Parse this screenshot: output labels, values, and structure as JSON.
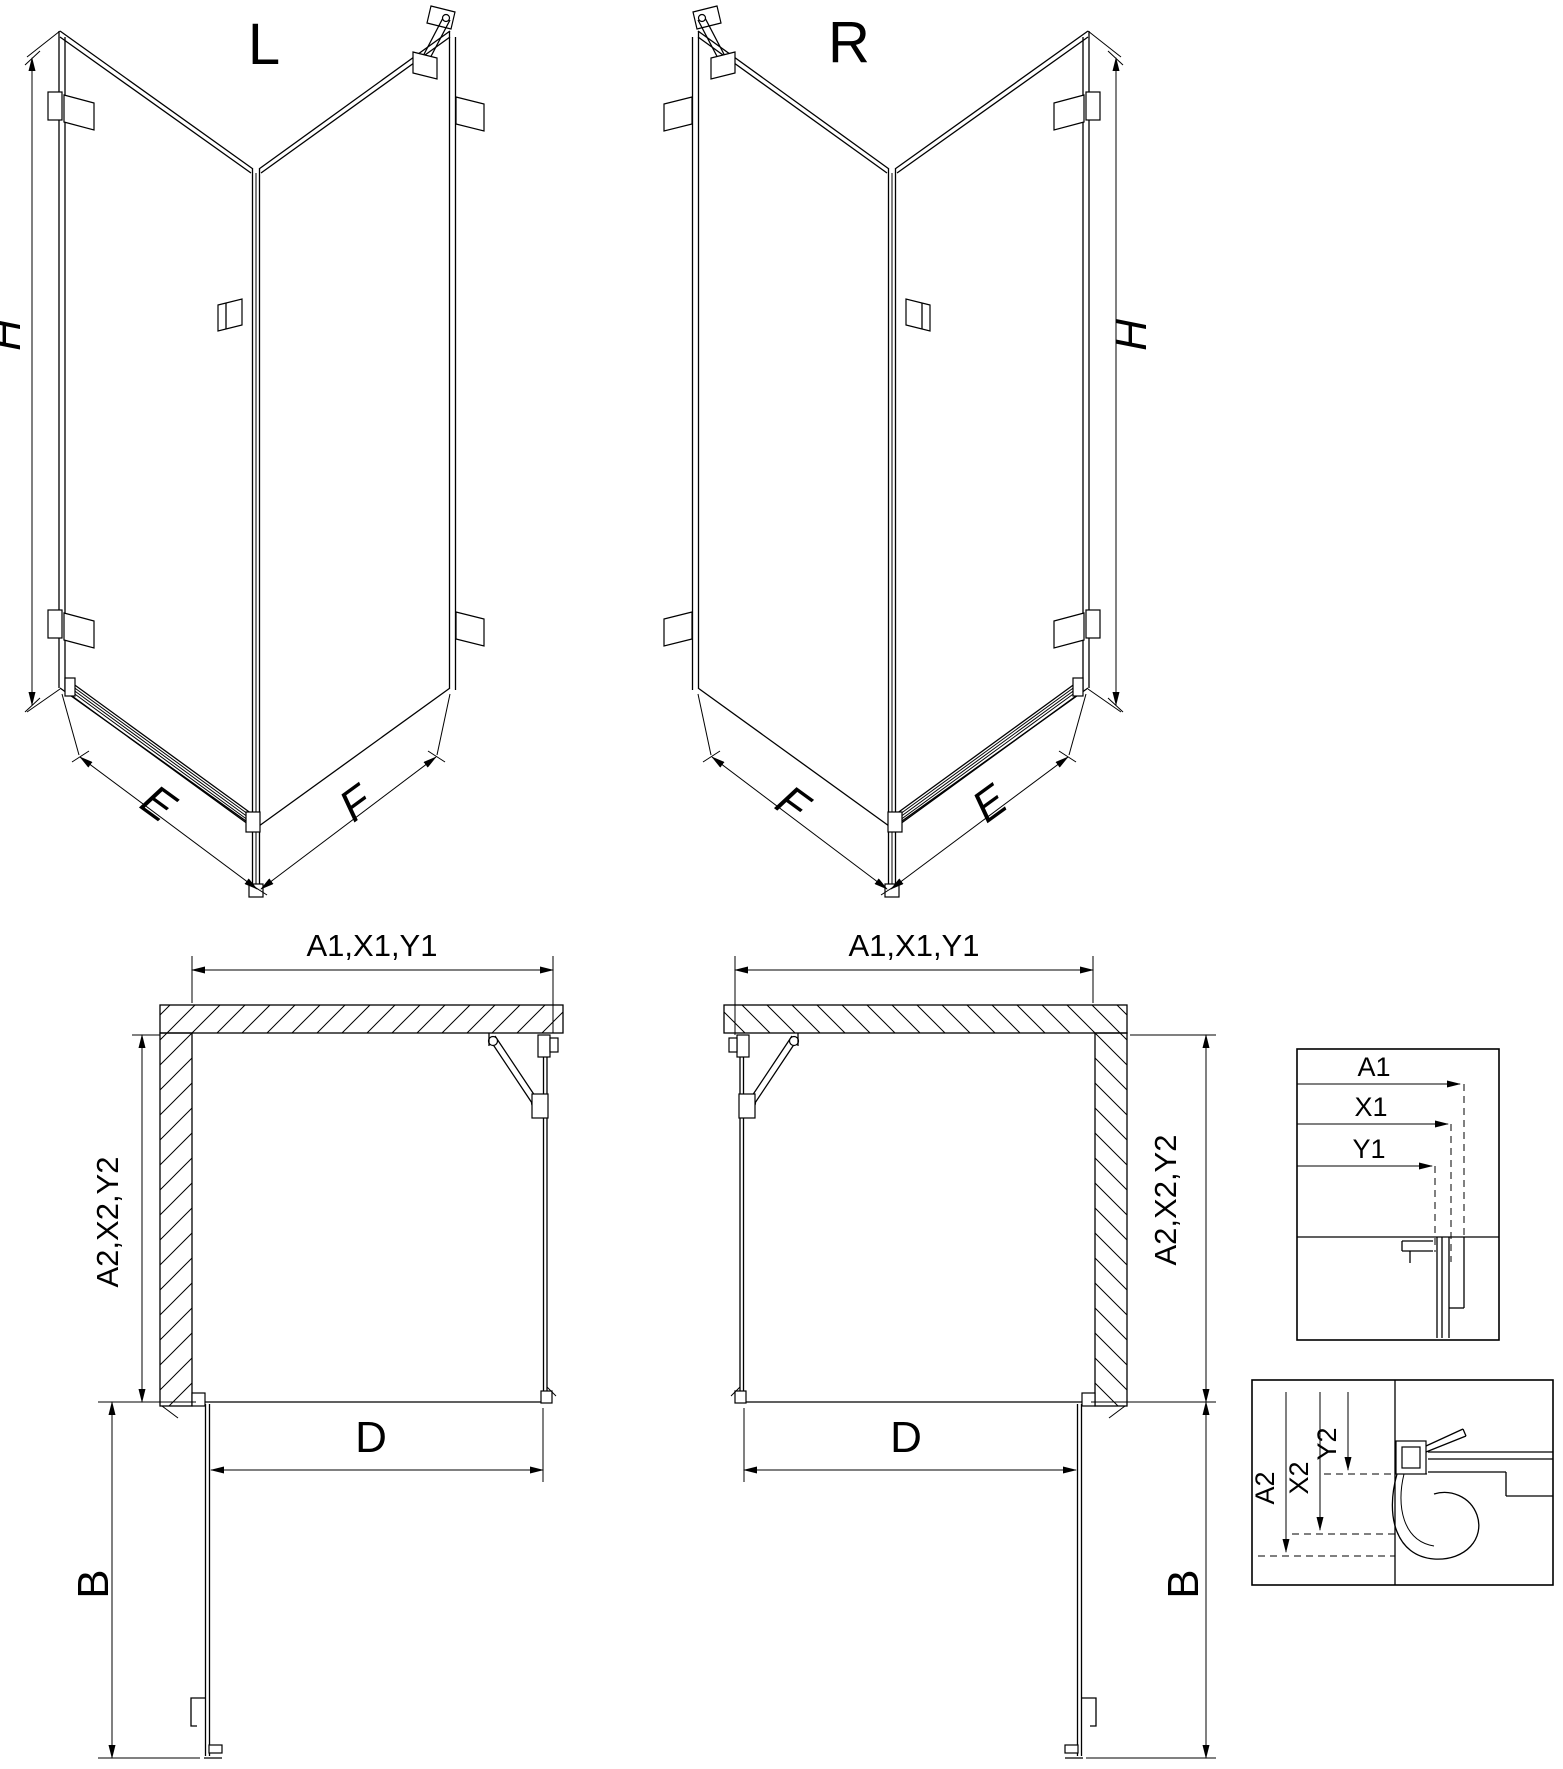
{
  "drawing": {
    "labels": {
      "left_variant": "L",
      "right_variant": "R",
      "height": "H",
      "door_side": "E",
      "fixed_side": "F",
      "plan_top": "A1,X1,Y1",
      "plan_side": "A2,X2,Y2",
      "opening_width": "D",
      "door_projection": "B"
    },
    "detail_horizontal": {
      "a1": "A1",
      "x1": "X1",
      "y1": "Y1"
    },
    "detail_vertical": {
      "a2": "A2",
      "x2": "X2",
      "y2": "Y2"
    },
    "colors": {
      "line": "#000000",
      "background": "#ffffff"
    }
  }
}
